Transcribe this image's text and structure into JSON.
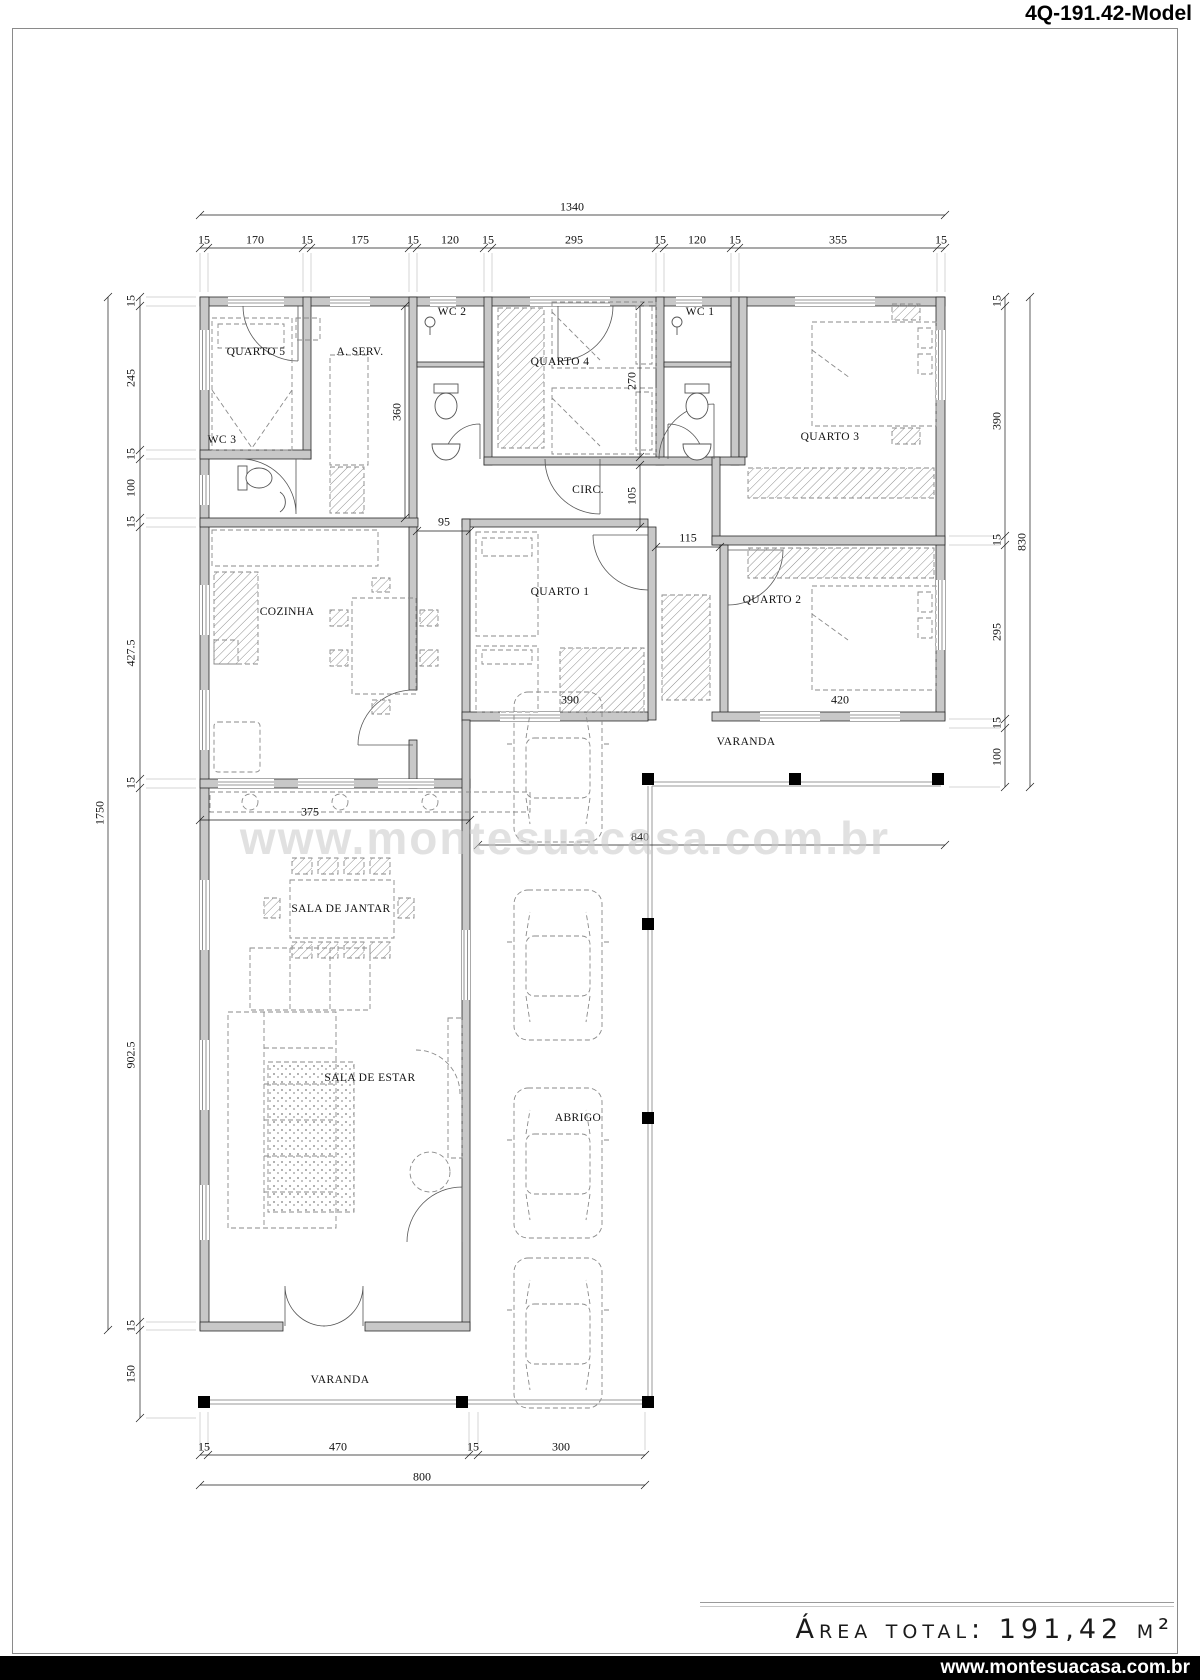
{
  "title": "4Q-191.42-Model",
  "watermark": "www.montesuacasa.com.br",
  "footer": {
    "area_text": "Área total: 191,42 m²",
    "website": "www.montesuacasa.com.br"
  },
  "plan": {
    "labels": [
      {
        "n": "room-quarto-5",
        "t": "QUARTO 5",
        "x": 256,
        "y": 352,
        "c": "room"
      },
      {
        "n": "room-a-serv",
        "t": "A. SERV.",
        "x": 360,
        "y": 352,
        "c": "room"
      },
      {
        "n": "room-wc-2",
        "t": "WC 2",
        "x": 452,
        "y": 312,
        "c": "room"
      },
      {
        "n": "room-quarto-4",
        "t": "QUARTO 4",
        "x": 560,
        "y": 362,
        "c": "room"
      },
      {
        "n": "room-wc-1",
        "t": "WC 1",
        "x": 700,
        "y": 312,
        "c": "room"
      },
      {
        "n": "room-quarto-3",
        "t": "QUARTO 3",
        "x": 830,
        "y": 437,
        "c": "room"
      },
      {
        "n": "room-wc-3",
        "t": "WC 3",
        "x": 222,
        "y": 440,
        "c": "room"
      },
      {
        "n": "room-circ",
        "t": "CIRC.",
        "x": 588,
        "y": 490,
        "c": "room"
      },
      {
        "n": "room-cozinha",
        "t": "COZINHA",
        "x": 287,
        "y": 612,
        "c": "room"
      },
      {
        "n": "room-quarto-1",
        "t": "QUARTO 1",
        "x": 560,
        "y": 592,
        "c": "room"
      },
      {
        "n": "room-quarto-2",
        "t": "QUARTO 2",
        "x": 772,
        "y": 600,
        "c": "room"
      },
      {
        "n": "room-varanda-upper",
        "t": "VARANDA",
        "x": 746,
        "y": 742,
        "c": "room"
      },
      {
        "n": "room-sala-jantar",
        "t": "SALA DE JANTAR",
        "x": 341,
        "y": 909,
        "c": "room"
      },
      {
        "n": "room-sala-estar",
        "t": "SALA DE ESTAR",
        "x": 370,
        "y": 1078,
        "c": "room"
      },
      {
        "n": "room-abrigo",
        "t": "ABRIGO",
        "x": 578,
        "y": 1118,
        "c": "room"
      },
      {
        "n": "room-varanda-lower",
        "t": "VARANDA",
        "x": 340,
        "y": 1380,
        "c": "room"
      },
      {
        "n": "dim-total-width",
        "t": "1340",
        "x": 572,
        "y": 207,
        "c": "dim"
      },
      {
        "n": "dim-top-1",
        "t": "15",
        "x": 204,
        "y": 240,
        "c": "dim"
      },
      {
        "n": "dim-top-2",
        "t": "170",
        "x": 255,
        "y": 240,
        "c": "dim"
      },
      {
        "n": "dim-top-3",
        "t": "15",
        "x": 307,
        "y": 240,
        "c": "dim"
      },
      {
        "n": "dim-top-4",
        "t": "175",
        "x": 360,
        "y": 240,
        "c": "dim"
      },
      {
        "n": "dim-top-5",
        "t": "15",
        "x": 413,
        "y": 240,
        "c": "dim"
      },
      {
        "n": "dim-top-6",
        "t": "120",
        "x": 450,
        "y": 240,
        "c": "dim"
      },
      {
        "n": "dim-top-7",
        "t": "15",
        "x": 488,
        "y": 240,
        "c": "dim"
      },
      {
        "n": "dim-top-8",
        "t": "295",
        "x": 574,
        "y": 240,
        "c": "dim"
      },
      {
        "n": "dim-top-9",
        "t": "15",
        "x": 660,
        "y": 240,
        "c": "dim"
      },
      {
        "n": "dim-top-10",
        "t": "120",
        "x": 697,
        "y": 240,
        "c": "dim"
      },
      {
        "n": "dim-top-11",
        "t": "15",
        "x": 735,
        "y": 240,
        "c": "dim"
      },
      {
        "n": "dim-top-12",
        "t": "355",
        "x": 838,
        "y": 240,
        "c": "dim"
      },
      {
        "n": "dim-top-13",
        "t": "15",
        "x": 941,
        "y": 240,
        "c": "dim"
      },
      {
        "n": "dim-total-height",
        "t": "1750",
        "x": 100,
        "y": 813,
        "r": -90,
        "c": "dim"
      },
      {
        "n": "dim-left-1",
        "t": "15",
        "x": 131,
        "y": 301,
        "r": -90,
        "c": "dim"
      },
      {
        "n": "dim-left-2",
        "t": "245",
        "x": 131,
        "y": 378,
        "r": -90,
        "c": "dim"
      },
      {
        "n": "dim-left-3",
        "t": "15",
        "x": 131,
        "y": 454,
        "r": -90,
        "c": "dim"
      },
      {
        "n": "dim-left-4",
        "t": "100",
        "x": 131,
        "y": 488,
        "r": -90,
        "c": "dim"
      },
      {
        "n": "dim-left-5",
        "t": "15",
        "x": 131,
        "y": 522,
        "r": -90,
        "c": "dim"
      },
      {
        "n": "dim-left-6",
        "t": "427.5",
        "x": 131,
        "y": 653,
        "r": -90,
        "c": "dim"
      },
      {
        "n": "dim-left-7",
        "t": "15",
        "x": 131,
        "y": 783,
        "r": -90,
        "c": "dim"
      },
      {
        "n": "dim-left-8",
        "t": "902.5",
        "x": 131,
        "y": 1055,
        "r": -90,
        "c": "dim"
      },
      {
        "n": "dim-left-9",
        "t": "15",
        "x": 131,
        "y": 1326,
        "r": -90,
        "c": "dim"
      },
      {
        "n": "dim-left-10",
        "t": "150",
        "x": 131,
        "y": 1374,
        "r": -90,
        "c": "dim"
      },
      {
        "n": "dim-right-1",
        "t": "15",
        "x": 997,
        "y": 301,
        "r": -90,
        "c": "dim"
      },
      {
        "n": "dim-right-2",
        "t": "390",
        "x": 997,
        "y": 421,
        "r": -90,
        "c": "dim"
      },
      {
        "n": "dim-right-3",
        "t": "15",
        "x": 997,
        "y": 540,
        "r": -90,
        "c": "dim"
      },
      {
        "n": "dim-right-4",
        "t": "295",
        "x": 997,
        "y": 632,
        "r": -90,
        "c": "dim"
      },
      {
        "n": "dim-right-5",
        "t": "15",
        "x": 997,
        "y": 723,
        "r": -90,
        "c": "dim"
      },
      {
        "n": "dim-right-6",
        "t": "100",
        "x": 997,
        "y": 757,
        "r": -90,
        "c": "dim"
      },
      {
        "n": "dim-right-total",
        "t": "830",
        "x": 1022,
        "y": 542,
        "r": -90,
        "c": "dim"
      },
      {
        "n": "dim-bottom-1",
        "t": "15",
        "x": 204,
        "y": 1447,
        "c": "dim"
      },
      {
        "n": "dim-bottom-2",
        "t": "470",
        "x": 338,
        "y": 1447,
        "c": "dim"
      },
      {
        "n": "dim-bottom-3",
        "t": "15",
        "x": 473,
        "y": 1447,
        "c": "dim"
      },
      {
        "n": "dim-bottom-4",
        "t": "300",
        "x": 561,
        "y": 1447,
        "c": "dim"
      },
      {
        "n": "dim-bottom-total",
        "t": "800",
        "x": 422,
        "y": 1477,
        "c": "dim"
      },
      {
        "n": "dim-aserv-depth",
        "t": "360",
        "x": 397,
        "y": 412,
        "r": -90,
        "c": "dim"
      },
      {
        "n": "dim-quarto4-depth",
        "t": "270",
        "x": 632,
        "y": 381,
        "r": -90,
        "c": "dim"
      },
      {
        "n": "dim-circ-depth",
        "t": "105",
        "x": 632,
        "y": 496,
        "r": -90,
        "c": "dim"
      },
      {
        "n": "dim-gap-95",
        "t": "95",
        "x": 444,
        "y": 522,
        "c": "dim"
      },
      {
        "n": "dim-hall-115",
        "t": "115",
        "x": 688,
        "y": 538,
        "c": "dim"
      },
      {
        "n": "dim-quarto1-width",
        "t": "390",
        "x": 570,
        "y": 700,
        "c": "dim"
      },
      {
        "n": "dim-quarto2-width",
        "t": "420",
        "x": 840,
        "y": 700,
        "c": "dim"
      },
      {
        "n": "dim-jantar-width",
        "t": "375",
        "x": 310,
        "y": 812,
        "c": "dim"
      },
      {
        "n": "dim-varanda-width",
        "t": "840",
        "x": 640,
        "y": 837,
        "c": "dim"
      }
    ]
  }
}
